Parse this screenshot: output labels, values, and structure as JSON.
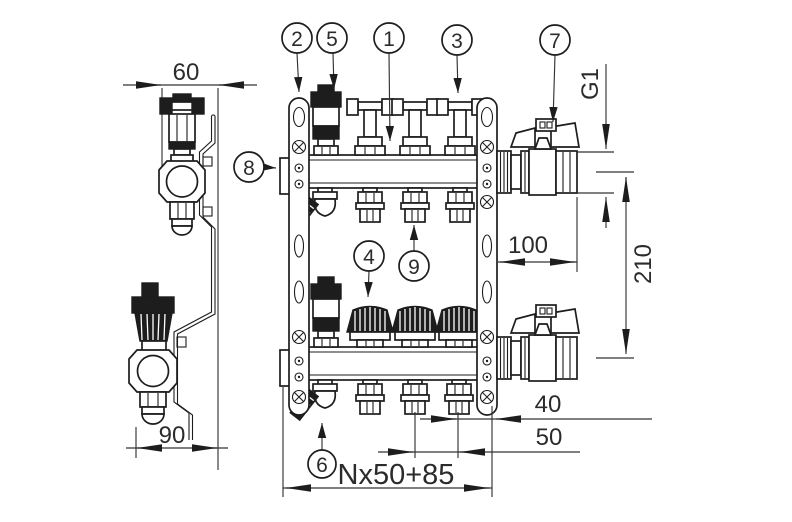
{
  "callouts": {
    "c1": "1",
    "c2": "2",
    "c3": "3",
    "c4": "4",
    "c5": "5",
    "c6": "6",
    "c7": "7",
    "c8": "8",
    "c9": "9"
  },
  "dimensions": {
    "side_width": "60",
    "side_depth": "90",
    "thread_size": "G1",
    "end_offset": "100",
    "row_distance": "210",
    "bracket_offset": "40",
    "outlet_spacing": "50",
    "total_length": "Nx50+85"
  },
  "colors": {
    "line": "#1d1d1d",
    "dimension_line": "#333333",
    "background": "#ffffff"
  }
}
